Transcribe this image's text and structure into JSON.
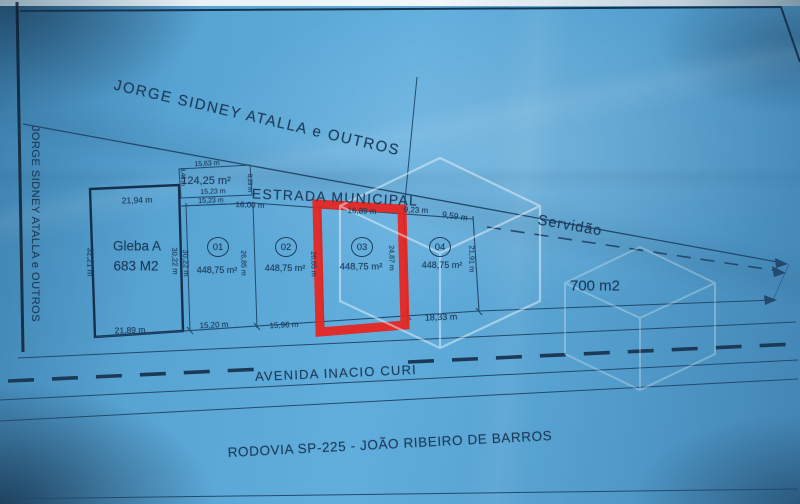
{
  "colors": {
    "paper": "#57a3d2",
    "ink": "#1d3d5c",
    "highlight": "#e8231d",
    "watermark": "#eaf3f9"
  },
  "plan": {
    "neighbor_top": "JORGE SIDNEY ATALLA e OUTROS",
    "neighbor_left": "JORGE SIDNEY ATALLA e OUTROS",
    "municipal_road": "ESTRADA MUNICIPAL",
    "servidao_label": "Servidão",
    "servidao_area": "700 m2",
    "servidao_frontage": "9,59 m",
    "avenue": "AVENIDA INACIO CURI",
    "highway": "RODOVIA SP-225 - JOÃO RIBEIRO DE BARROS",
    "gleba": {
      "name": "Gleba A",
      "area": "683 M2",
      "top": "21,94 m",
      "bottom": "21,89 m",
      "left": "32,21 m",
      "right_inner": "30,22 m",
      "right_outer": "30,22 m"
    },
    "small_parcel": {
      "area": "124,25 m²",
      "top": "15,63 m",
      "bottom_upper": "15,23 m",
      "bottom_lower": "15,23 m",
      "left": "8,46 m",
      "right": "8,29 m"
    },
    "lots": [
      {
        "number": "01",
        "area": "448,75 m²",
        "bottom": "15,20 m",
        "side": "26,85 m"
      },
      {
        "number": "02",
        "area": "448,75 m²",
        "top": "16,00 m",
        "bottom": "15,96 m",
        "side": "26,65 m"
      },
      {
        "number": "03",
        "area": "448,75 m²",
        "top": "16,89 m",
        "side": "24,87 m"
      },
      {
        "number": "04",
        "area": "448,75 m²",
        "top": "9,23 m",
        "bottom": "18,33 m",
        "side": "21,91 m"
      }
    ]
  }
}
